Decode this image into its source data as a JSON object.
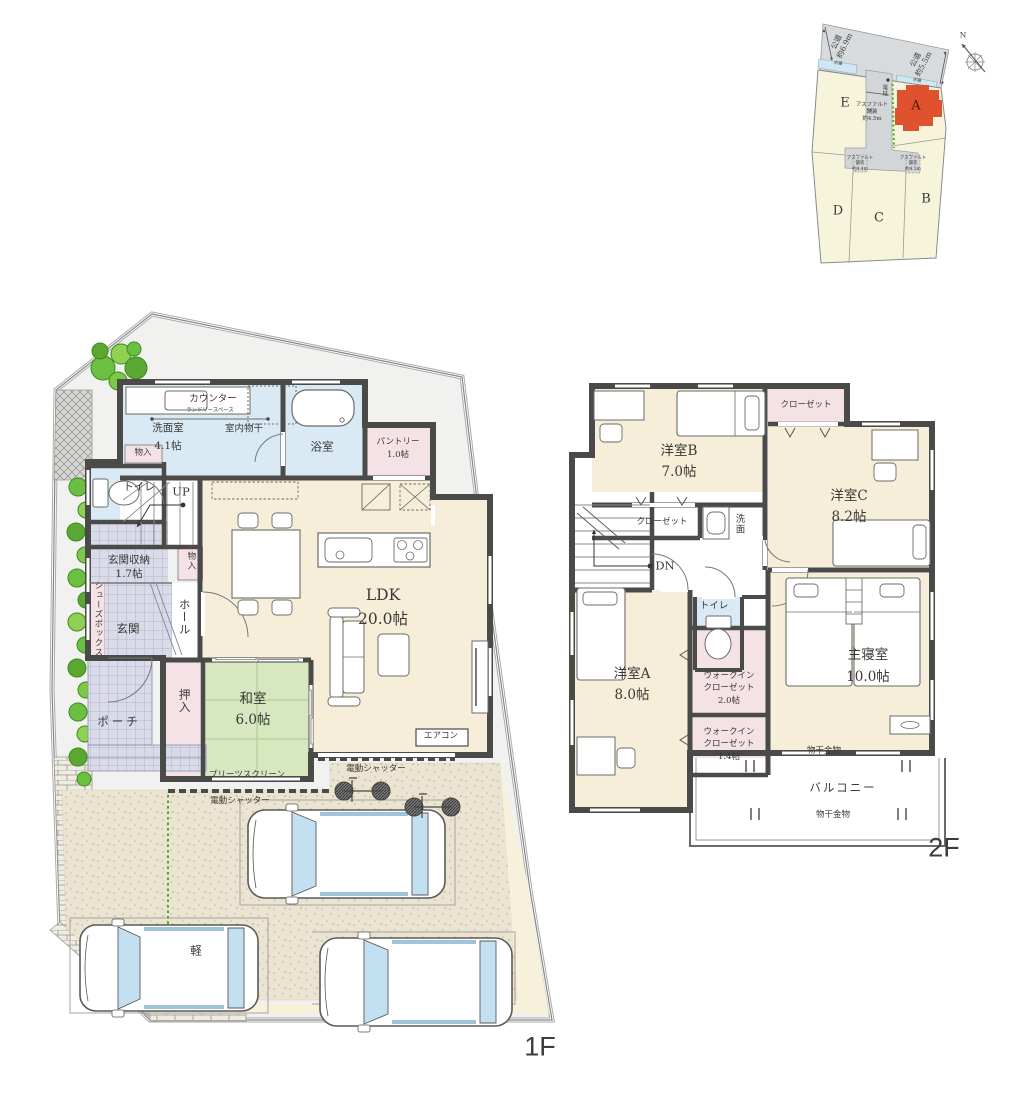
{
  "site_plan": {
    "road_left": {
      "l1": "公道",
      "l2": "約6.9m"
    },
    "road_right": {
      "l1": "公道",
      "l2": "約5.5m"
    },
    "waterway_left": "水路",
    "waterway_right": "水路",
    "utility_pole": "電柱",
    "driveway": {
      "l1": "アスファルト",
      "l2": "舗装",
      "l3": "約4.5m"
    },
    "paving_left": {
      "l1": "アスファルト",
      "l2": "舗装",
      "l3": "約4.4m"
    },
    "paving_right": {
      "l1": "アスファルト",
      "l2": "舗装",
      "l3": "約4.5m"
    },
    "north": "N",
    "lot_a": "A",
    "lot_b": "B",
    "lot_c": "C",
    "lot_d": "D",
    "lot_e": "E"
  },
  "floor1": {
    "floor_label": "1F",
    "ldk_name": "LDK",
    "ldk_size": "20.0帖",
    "washitsu_name": "和室",
    "washitsu_size": "6.0帖",
    "senmen_name": "洗面室",
    "senmen_size": "4.1帖",
    "counter": "カウンター",
    "laundry_space": "ランドリースペース",
    "indoor_drying": "室内物干",
    "bath": "浴室",
    "pantry_name": "パントリー",
    "pantry_size": "1.0帖",
    "monoire_top": "物入",
    "toilet": "トイレ",
    "up": "UP",
    "genkan_storage_name": "玄関収納",
    "genkan_storage_size": "1.7帖",
    "monoire_hall": "物入",
    "shoes_box": "シューズボックス",
    "genkan": "玄関",
    "hall": "ホール",
    "porch": "ポーチ",
    "oshiire": "押入",
    "pleats_screen": "プリーツスクリーン",
    "aircon": "エアコン",
    "shutter_right": "電動シャッター",
    "shutter_left": "電動シャッター",
    "kei": "軽"
  },
  "floor2": {
    "floor_label": "2F",
    "room_b_name": "洋室B",
    "room_b_size": "7.0帖",
    "closet_top": "クローゼット",
    "room_c_name": "洋室C",
    "room_c_size": "8.2帖",
    "closet_b": "クローゼット",
    "senmen": "洗面",
    "dn": "DN",
    "toilet": "トイレ",
    "room_a_name": "洋室A",
    "room_a_size": "8.0帖",
    "wic2_l1": "ウォークイン",
    "wic2_l2": "クローゼット",
    "wic2_size": "2.0帖",
    "wic14_l1": "ウォークイン",
    "wic14_l2": "クローゼット",
    "wic14_size": "1.4帖",
    "master_name": "主寝室",
    "master_size": "10.0帖",
    "monohoshi_top": "物干金物",
    "monohoshi_bottom": "物干金物",
    "balcony": "バルコニー"
  },
  "colors": {
    "wall": "#4a4a48",
    "room_cream": "#f6eed9",
    "wet_blue": "#d9eaf5",
    "closet_pink": "#f4e2e6",
    "tatami_green": "#d7e7bf",
    "tile_lavender": "#d9dbe9",
    "lot_highlight": "#e0512f",
    "road_gray": "#d7dbde",
    "lot_cream": "#f7f4dc",
    "water_blue": "#cfe6f4"
  }
}
